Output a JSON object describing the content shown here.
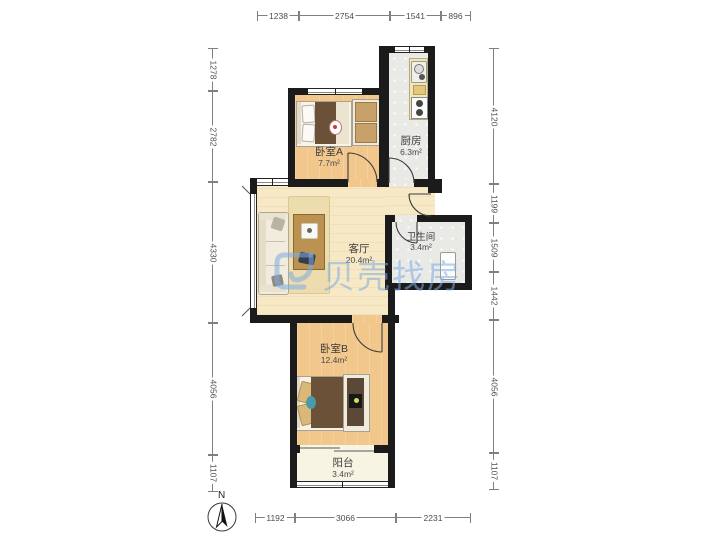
{
  "rooms": [
    {
      "id": "bedroomA",
      "name": "卧室A",
      "area": "7.7m²"
    },
    {
      "id": "kitchen",
      "name": "厨房",
      "area": "6.3m²"
    },
    {
      "id": "living",
      "name": "客厅",
      "area": "20.4m²"
    },
    {
      "id": "bathroom",
      "name": "卫生间",
      "area": "3.4m²"
    },
    {
      "id": "bedroomB",
      "name": "卧室B",
      "area": "12.4m²"
    },
    {
      "id": "balcony",
      "name": "阳台",
      "area": "3.4m²"
    }
  ],
  "dimensions": {
    "top": [
      "1238",
      "2754",
      "1541",
      "896"
    ],
    "bottom": [
      "1192",
      "3066",
      "2231"
    ],
    "left": [
      "1278",
      "2782",
      "4330",
      "4056",
      "1107"
    ],
    "right": [
      "4120",
      "1199",
      "1509",
      "1442",
      "4056",
      "1107"
    ]
  },
  "watermark": {
    "text": "贝壳找房",
    "color": "#7dacE4"
  },
  "compass": {
    "north_label": "N"
  },
  "colors": {
    "wall": "#1b1b1b",
    "wood_floor": "#f2c78c",
    "living_floor": "#f7e9c6",
    "tile_floor": "#e9e9e6",
    "balcony_floor": "#f8f4e3",
    "blanket": "#6b5138",
    "teal_accent": "#4a9aaa",
    "watermark_blue": "#7dace4"
  }
}
